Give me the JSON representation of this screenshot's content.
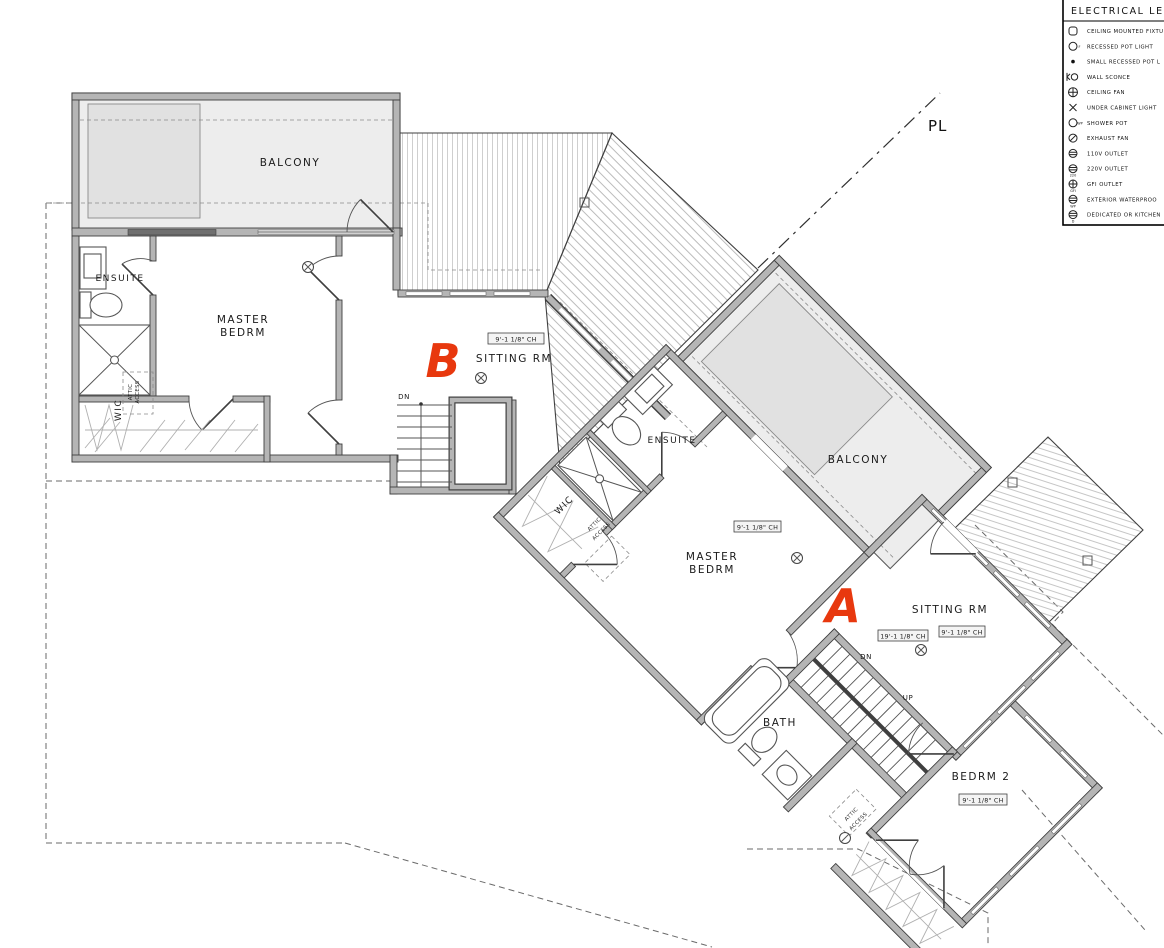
{
  "colors": {
    "accent_red": "#e8380e",
    "wall_gray": "#b5b5b5",
    "balcony_fill": "#ededed"
  },
  "legend": {
    "title": "ELECTRICAL LE",
    "items": [
      {
        "name": "ceiling-mounted-fixture",
        "label": "CEILING MOUNTED FIXTU",
        "tag": ""
      },
      {
        "name": "recessed-pot-light",
        "label": "RECESSED POT LIGHT",
        "tag": "F"
      },
      {
        "name": "small-recessed-pot-light",
        "label": "SMALL RECESSED POT L",
        "tag": ""
      },
      {
        "name": "wall-sconce",
        "label": "WALL SCONCE",
        "tag": ""
      },
      {
        "name": "ceiling-fan",
        "label": "CEILING FAN",
        "tag": ""
      },
      {
        "name": "under-cabinet-light",
        "label": "UNDER CABINET LIGHT",
        "tag": ""
      },
      {
        "name": "shower-pot",
        "label": "SHOWER POT",
        "tag": "WP"
      },
      {
        "name": "exhaust-fan",
        "label": "EXHAUST FAN",
        "tag": ""
      },
      {
        "name": "outlet-110v",
        "label": "110V OUTLET",
        "tag": ""
      },
      {
        "name": "outlet-220v",
        "label": "220V OUTLET",
        "tag": "220"
      },
      {
        "name": "gfi-outlet",
        "label": "GFI OUTLET",
        "tag": "GFI"
      },
      {
        "name": "exterior-waterproof-outlet",
        "label": "EXTERIOR WATERPROO",
        "tag": "WP"
      },
      {
        "name": "dedicated-kitchen-outlet",
        "label": "DEDICATED OR KITCHEN",
        "tag": "D"
      }
    ]
  },
  "plan": {
    "property_line": "PL",
    "unit_b": {
      "unit_label": "B",
      "balcony": "BALCONY",
      "master_line1": "MASTER",
      "master_line2": "BEDRM",
      "ensuite": "ENSUITE",
      "wic": "WIC",
      "attic_line1": "ATTIC",
      "attic_line2": "ACCESS",
      "sitting": "SITTING RM",
      "sitting_ch": "9'-1 1/8\" CH",
      "dn": "DN"
    },
    "unit_a": {
      "unit_label": "A",
      "balcony": "BALCONY",
      "master_line1": "MASTER",
      "master_line2": "BEDRM",
      "master_ch": "9'-1 1/8\" CH",
      "ensuite": "ENSUITE",
      "wic": "WIC",
      "attic_wic_line1": "ATTIC",
      "attic_wic_line2": "ACCESS",
      "sitting": "SITTING RM",
      "sitting_ch_high": "19'-1 1/8\" CH",
      "sitting_ch": "9'-1 1/8\" CH",
      "bath": "BATH",
      "bedrm2": "BEDRM 2",
      "bedrm2_ch": "9'-1 1/8\" CH",
      "attic_closet_line1": "ATTIC",
      "attic_closet_line2": "ACCESS",
      "dn": "DN",
      "up": "UP"
    }
  }
}
